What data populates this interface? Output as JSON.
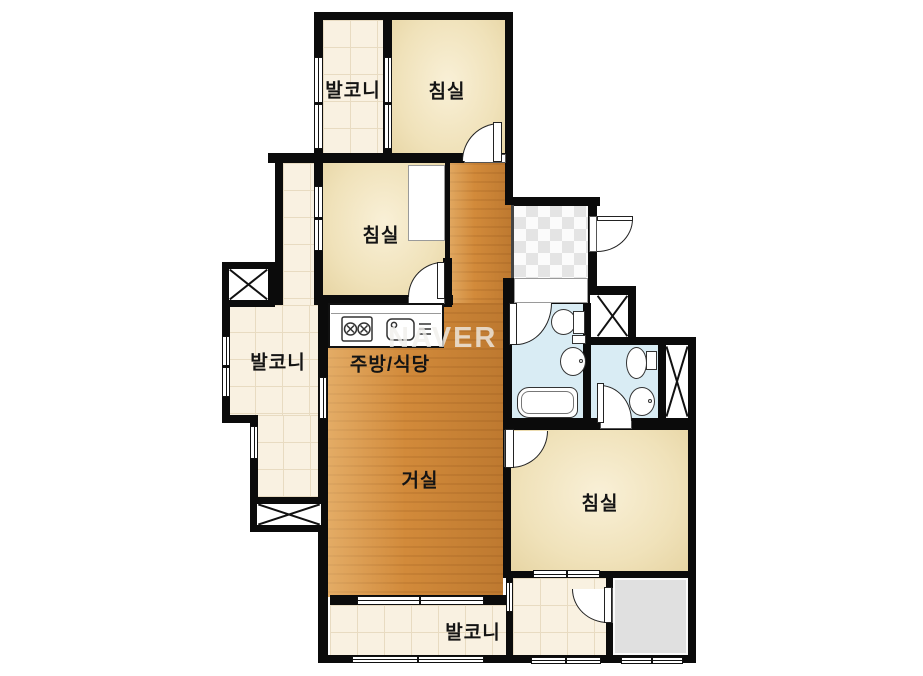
{
  "watermark": "NAVER",
  "rooms": {
    "balcony_top": {
      "label": "발코니"
    },
    "bedroom_top": {
      "label": "침실"
    },
    "bedroom_mid": {
      "label": "침실"
    },
    "balcony_left": {
      "label": "발코니"
    },
    "kitchen_dining": {
      "label": "주방/식당"
    },
    "living": {
      "label": "거실"
    },
    "bedroom_right": {
      "label": "침실"
    },
    "balcony_bottom": {
      "label": "발코니"
    }
  },
  "colors": {
    "wall": "#0b0b0b",
    "wood_floor": "#d28a3a",
    "room_floor": "#f0e2ba",
    "balcony_tile": "#f9f1e1",
    "bathroom_tile": "#d9ecf4",
    "entry_checker": "#e4e4e4",
    "utility_gray": "#e0e0e0"
  }
}
